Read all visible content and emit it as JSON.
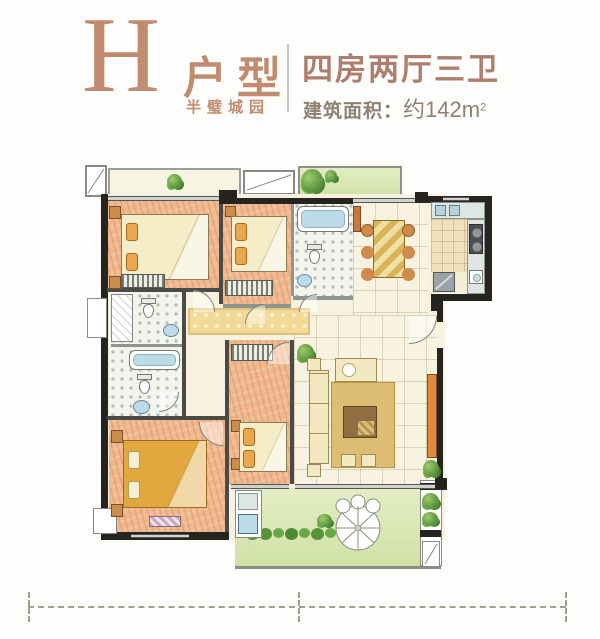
{
  "header": {
    "unit_letter": "H",
    "unit_type_label": "户型",
    "project_name": "半璧城园",
    "layout_summary": "四房两厅三卫",
    "area_label": "建筑面积：",
    "area_value": "约142m",
    "area_exponent": "2"
  },
  "palette": {
    "accent": "#c18b6f",
    "summary-text": "#ad7e6e",
    "area-text": "#8e8174",
    "wall-dark": "#26241f",
    "wall-gray": "#8f948e",
    "wood-floor": "#efb88e",
    "bed-cream": "#f5ecc8",
    "pillow-orange": "#e9a84e",
    "blanket-gold": "#e0a83f",
    "tile-floor": "#f7f3e0",
    "carpet-gold": "#f2d995",
    "bath-floor": "#f2f4ee",
    "tub-blue": "#bedce8",
    "balcony-green": "#d8e6b2",
    "plant-green": "#55903a",
    "rug-gold": "#dcbd72",
    "cabinet-orange": "#dd8a3c",
    "counter-gray": "#dde6e2",
    "kitchen-tile": "#f0e2bd",
    "table-wood": "#d8b35a"
  },
  "floorplan": {
    "rooms": [
      "bedroom-1",
      "bedroom-2",
      "bedroom-3",
      "master-bedroom",
      "bathroom-top",
      "bathroom-left-1",
      "bathroom-left-2",
      "dining-room",
      "living-room",
      "kitchen",
      "corridor",
      "balcony-top",
      "garden-balcony"
    ],
    "features": [
      "beds",
      "wardrobes",
      "dining-table-six-chairs",
      "sofa-set",
      "tv-cabinet",
      "bathtubs",
      "toilets",
      "sinks",
      "stove",
      "fridge",
      "washing-machine",
      "garden-umbrella",
      "hedge",
      "plants",
      "property-dashed-line"
    ]
  }
}
